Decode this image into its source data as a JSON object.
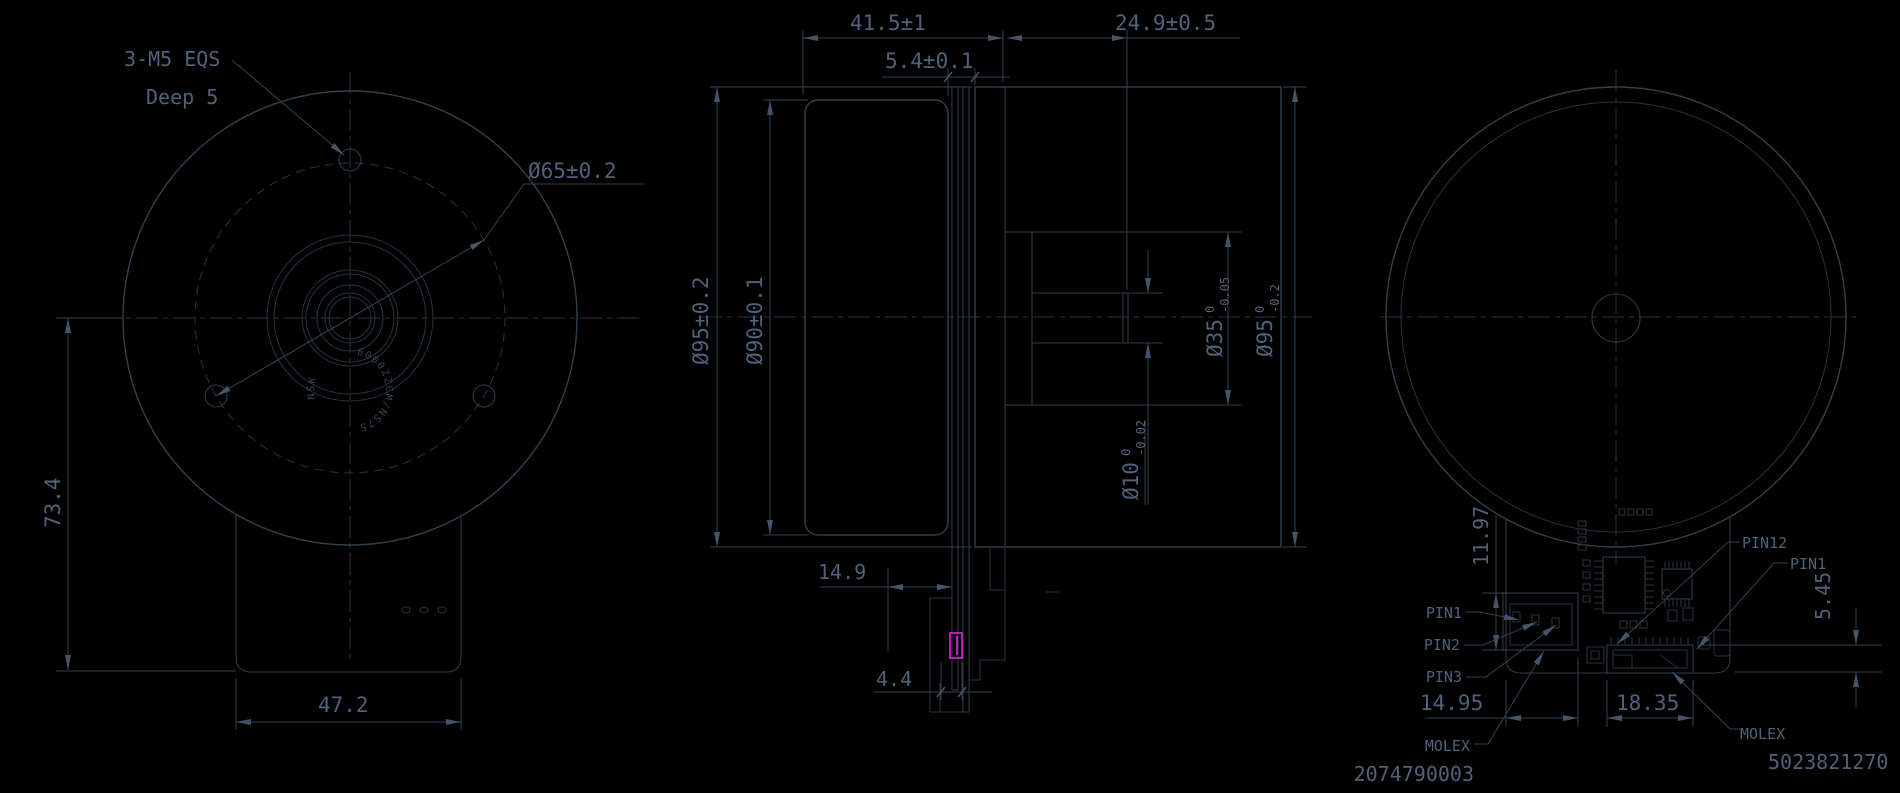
{
  "colors": {
    "background": "#000000",
    "line": "#2d3a47",
    "text": "#50617a",
    "highlight": "#e81ee8"
  },
  "front_view": {
    "thread_note_line1": "3-M5 EQS",
    "thread_note_line2": "Deep 5",
    "bolt_circle_dim": "Ø65±0.2",
    "overall_height_dim": "73.4",
    "body_width_dim": "47.2",
    "bearing_marking": "6000ZZCM/NS7S",
    "bearing_brand": "NSK"
  },
  "section_view": {
    "rotor_length_dim": "41.5±1",
    "rear_depth_dim": "24.9±0.5",
    "flange_thickness_dim": "5.4±0.1",
    "outer_dia_dim": "Ø95±0.2",
    "rotor_dia_dim": "Ø90±0.1",
    "boss_dia": "Ø35",
    "boss_tol_high": "0",
    "boss_tol_low": "-0.05",
    "rear_dia": "Ø95",
    "rear_tol_high": "0",
    "rear_tol_low": "-0.2",
    "shaft_dia": "Ø10",
    "shaft_tol_high": "0",
    "shaft_tol_low": "-0.02",
    "pcb_offset_dim": "14.9",
    "connector_thickness_dim": "4.4"
  },
  "rear_view": {
    "pcb_edge_dim": "11.97",
    "connector_height_dim": "5.45",
    "power_connector_width_dim": "14.95",
    "signal_connector_width_dim": "18.35",
    "pin1_label": "PIN1",
    "pin2_label": "PIN2",
    "pin3_label": "PIN3",
    "pin12_label": "PIN12",
    "pin1_right_label": "PIN1",
    "power_connector_brand": "MOLEX",
    "power_connector_part": "2074790003",
    "signal_connector_brand": "MOLEX",
    "signal_connector_part": "5023821270"
  }
}
